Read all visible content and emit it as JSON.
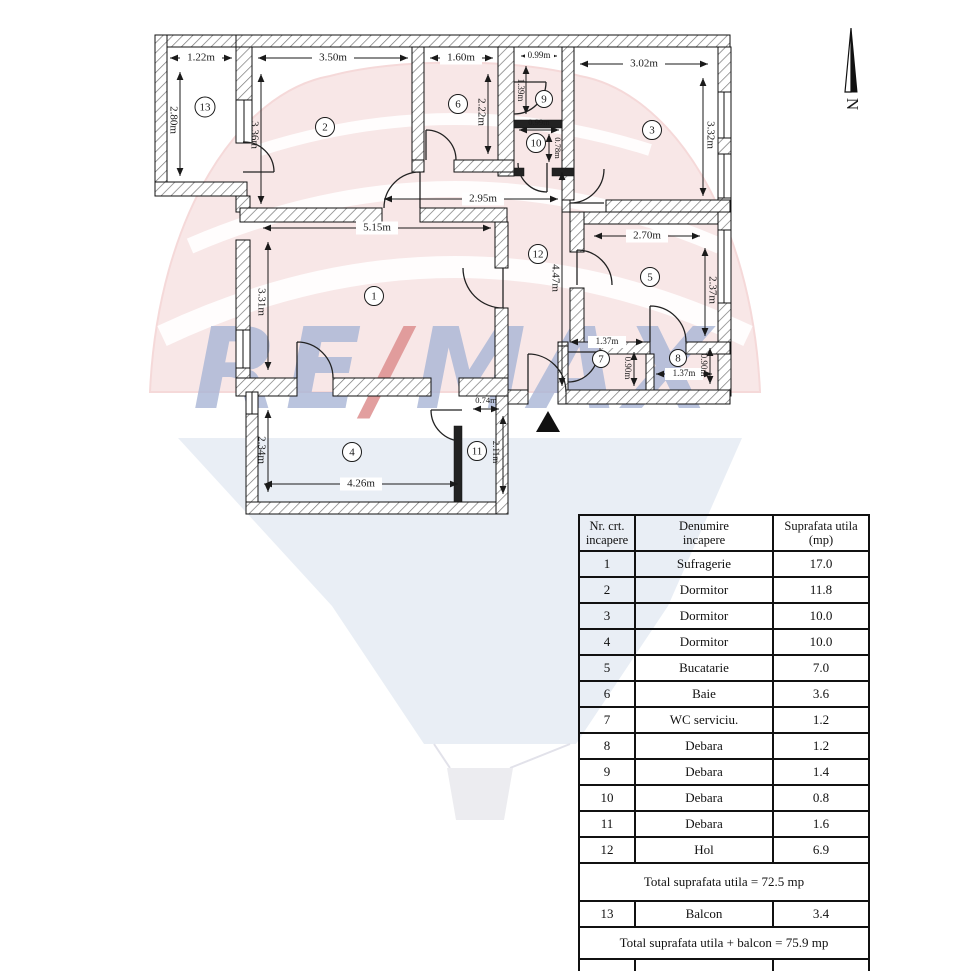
{
  "watermark": {
    "re": "RE",
    "slash": "/",
    "max": "MAX"
  },
  "plan": {
    "north_label": "N",
    "rooms": [
      {
        "n": "1"
      },
      {
        "n": "2"
      },
      {
        "n": "3"
      },
      {
        "n": "4"
      },
      {
        "n": "5"
      },
      {
        "n": "6"
      },
      {
        "n": "7"
      },
      {
        "n": "8"
      },
      {
        "n": "9"
      },
      {
        "n": "10"
      },
      {
        "n": "11"
      },
      {
        "n": "12"
      },
      {
        "n": "13"
      }
    ],
    "dims": [
      {
        "t": "1.22m"
      },
      {
        "t": "2.80m"
      },
      {
        "t": "3.50m"
      },
      {
        "t": "3.36m"
      },
      {
        "t": "1.60m"
      },
      {
        "t": "2.22m"
      },
      {
        "t": "0.99m"
      },
      {
        "t": "1.39m"
      },
      {
        "t": "3.02m"
      },
      {
        "t": "3.32m"
      },
      {
        "t": "0.99m"
      },
      {
        "t": "0.78m"
      },
      {
        "t": "2.95m"
      },
      {
        "t": "5.15m"
      },
      {
        "t": "3.31m"
      },
      {
        "t": "4.47m"
      },
      {
        "t": "2.70m"
      },
      {
        "t": "2.37m"
      },
      {
        "t": "1.37m"
      },
      {
        "t": "0.90m"
      },
      {
        "t": "1.37m"
      },
      {
        "t": "0.90m"
      },
      {
        "t": "2.34m"
      },
      {
        "t": "4.26m"
      },
      {
        "t": "0.74m"
      },
      {
        "t": "2.11m"
      }
    ]
  },
  "table": {
    "header": {
      "c1a": "Nr. crt.",
      "c1b": "incapere",
      "c2a": "Denumire",
      "c2b": "incapere",
      "c3a": "Suprafata utila",
      "c3b": "(mp)"
    },
    "rows": [
      {
        "nr": "1",
        "name": "Sufragerie",
        "area": "17.0"
      },
      {
        "nr": "2",
        "name": "Dormitor",
        "area": "11.8"
      },
      {
        "nr": "3",
        "name": "Dormitor",
        "area": "10.0"
      },
      {
        "nr": "4",
        "name": "Dormitor",
        "area": "10.0"
      },
      {
        "nr": "5",
        "name": "Bucatarie",
        "area": "7.0"
      },
      {
        "nr": "6",
        "name": "Baie",
        "area": "3.6"
      },
      {
        "nr": "7",
        "name": "WC serviciu.",
        "area": "1.2"
      },
      {
        "nr": "8",
        "name": "Debara",
        "area": "1.2"
      },
      {
        "nr": "9",
        "name": "Debara",
        "area": "1.4"
      },
      {
        "nr": "10",
        "name": "Debara",
        "area": "0.8"
      },
      {
        "nr": "11",
        "name": "Debara",
        "area": "1.6"
      },
      {
        "nr": "12",
        "name": "Hol",
        "area": "6.9"
      }
    ],
    "total_utila": "Total suprafata utila = 72.5 mp",
    "balcon_row": {
      "nr": "13",
      "name": "Balcon",
      "area": "3.4"
    },
    "total_cu_balcon": "Total suprafata utila + balcon = 75.9 mp"
  }
}
